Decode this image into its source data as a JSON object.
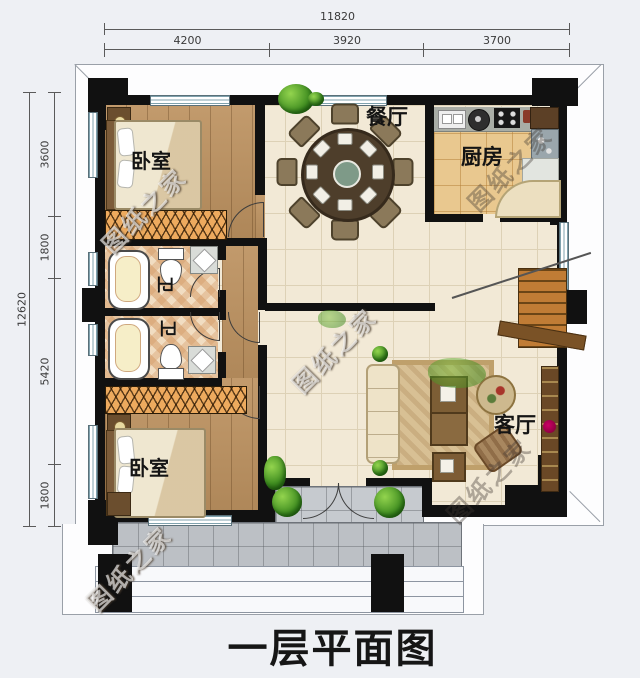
{
  "title": "一层平面图",
  "watermark": {
    "text": "图纸之家"
  },
  "dimensions": {
    "top": {
      "total": "11820",
      "segments": [
        "4200",
        "3920",
        "3700"
      ]
    },
    "left": {
      "total": "12620",
      "segments": [
        "3600",
        "1800",
        "5420",
        "1800"
      ]
    }
  },
  "rooms": {
    "bedroom_top": "卧室",
    "bedroom_bottom": "卧室",
    "bath_top": "卫",
    "bath_bottom": "卫",
    "dining": "餐厅",
    "kitchen": "厨房",
    "living": "客厅"
  },
  "colors": {
    "background": "#eef0f4",
    "wall": "#111111",
    "wood_floor": "#bd9260",
    "cream_tile": "#f2e9d6",
    "kitchen_tile": "#e9c88f",
    "bath_tile": "#f1ddc2",
    "porch": "#bcc0c5",
    "wardrobe_hatch": "#edaa5e",
    "stairs": "#c07c35",
    "window_frame": "#7fa1ad"
  }
}
